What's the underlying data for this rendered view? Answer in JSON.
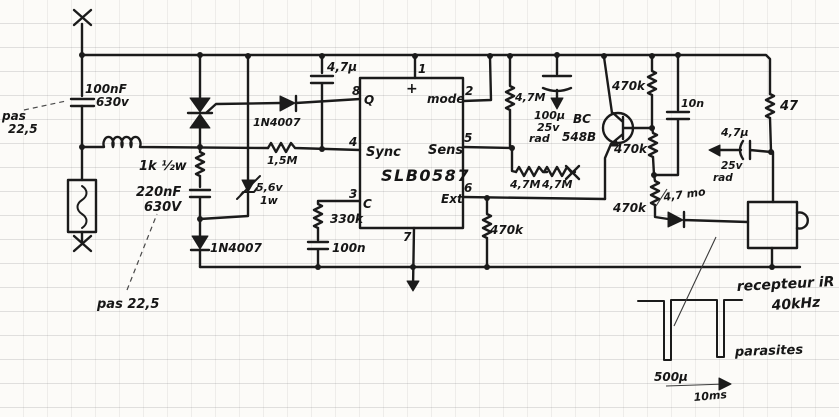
{
  "colors": {
    "ink": "#1b1b1b",
    "paper": "#fcfbf8"
  },
  "labels": {
    "pitch_top_1": "pas",
    "pitch_top_2": "22,5",
    "cap_100nf": "100nF",
    "cap_100nf_volt": "630v",
    "res_1k": "1k ½w",
    "cap_220nf": "220nF",
    "cap_220nf_volt": "630V",
    "pitch_bottom": "pas 22,5",
    "diode_bottom": "1N4007",
    "zener_volt": "5,6v",
    "zener_watt": "1w",
    "diode_top": "1N4007",
    "cap_4u7_left": "4,7µ",
    "res_1m5": "1,5M",
    "res_330k": "330k",
    "cap_100n_small": "100n",
    "ic_name": "SLB0587",
    "ic_plus": "+",
    "ic_q": "Q",
    "ic_mode": "mode",
    "ic_sync": "Sync",
    "ic_sens": "Sens",
    "ic_c": "C",
    "ic_ext": "Ext",
    "pin1": "1",
    "pin2": "2",
    "pin3": "3",
    "pin4": "4",
    "pin5": "5",
    "pin6": "6",
    "pin7": "7",
    "pin8": "8",
    "res_4m7_vert": "4,7M",
    "res_4m7_a": "4,7M",
    "res_4m7_b": "4,7M",
    "cap_100u": "100µ",
    "cap_100u_volt": "25v",
    "cap_100u_type": "rad",
    "transistor_line1": "BC",
    "transistor_line2": "548B",
    "res_470k_top": "470k",
    "res_470k_mid": "470k",
    "res_470k_low": "470k",
    "res_470k_ext": "470k",
    "cap_10n": "10n",
    "res_47": "47",
    "cap_4u7_right": "4,7µ",
    "cap_4u7_right_volt": "25v",
    "cap_4u7_right_type": "rad",
    "diode_ir_note": "4,7 mo",
    "receiver_line1": "recepteur iR",
    "receiver_line2": "40kHz",
    "wave_pulse_width": "500µ",
    "wave_period": "10ms",
    "wave_parasites": "parasites"
  }
}
